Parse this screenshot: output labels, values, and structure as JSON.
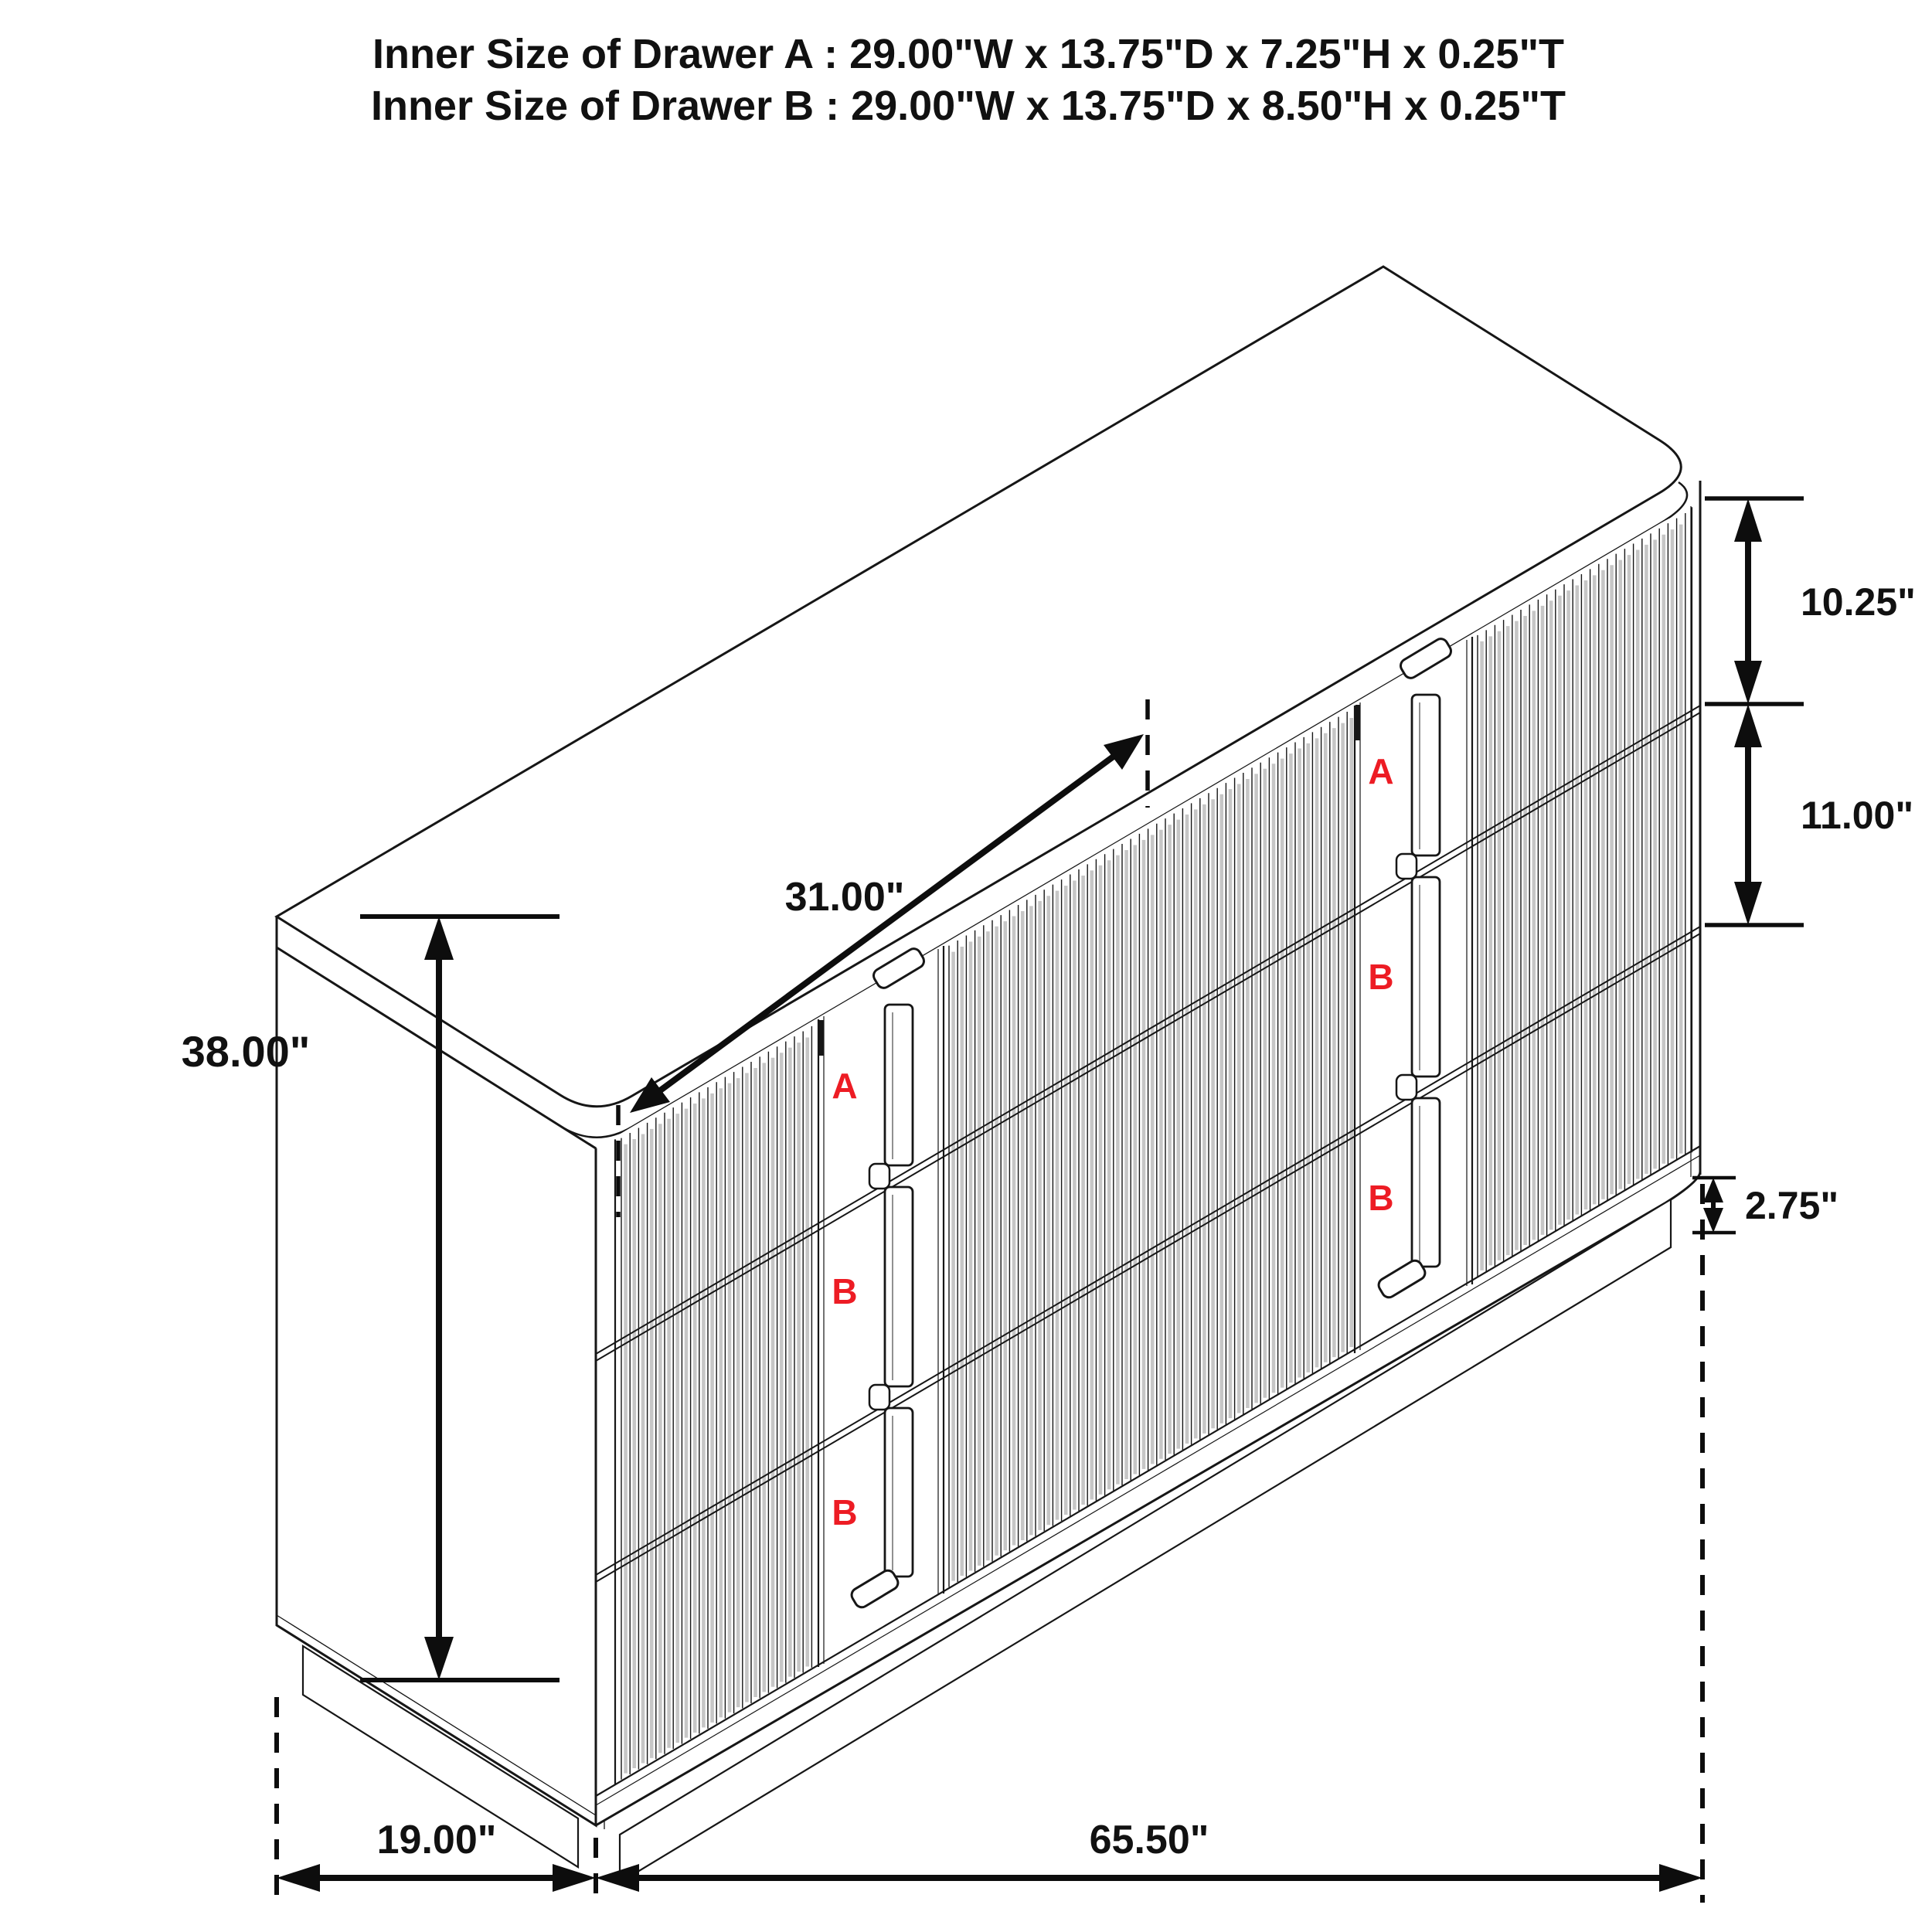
{
  "title": {
    "line1": "Inner Size of Drawer A : 29.00\"W x 13.75\"D x 7.25\"H x 0.25\"T",
    "line2": "Inner Size of Drawer B : 29.00\"W x 13.75\"D x 8.50\"H x 0.25\"T"
  },
  "dimensions": {
    "overall_height": "38.00\"",
    "overall_depth": "19.00\"",
    "overall_width": "65.50\"",
    "top_drawer_height": "10.25\"",
    "middle_drawer_height": "11.00\"",
    "base_height": "2.75\"",
    "drawer_unit_width": "31.00\""
  },
  "drawer_labels": {
    "left_column": [
      "A",
      "B",
      "B"
    ],
    "right_column": [
      "A",
      "B",
      "B"
    ]
  },
  "colors": {
    "line": "#161616",
    "dimension": "#0d0d0d",
    "drawer_label_red": "#ed1c24",
    "flute_shade": "#c6c6c6",
    "background": "#ffffff"
  }
}
